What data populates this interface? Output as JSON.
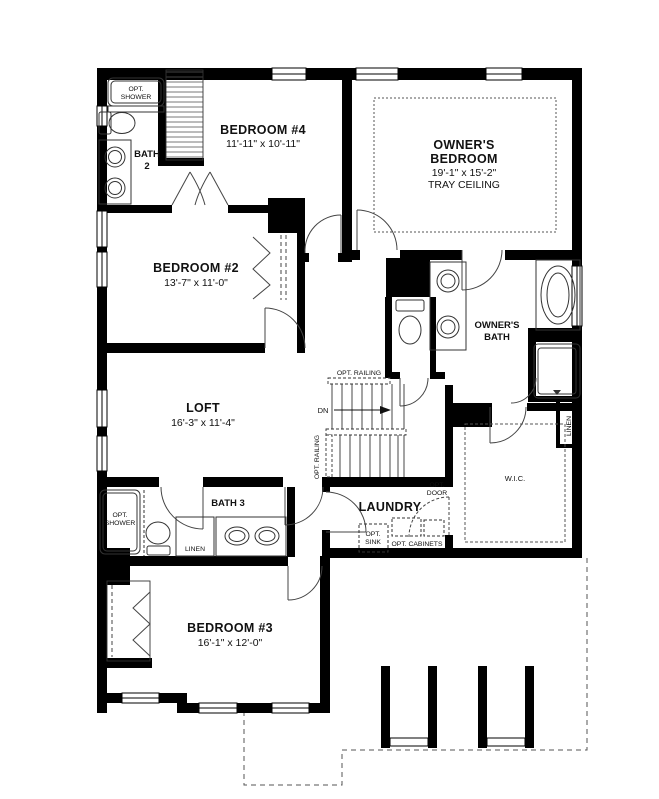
{
  "plan": {
    "rooms": {
      "bath2": {
        "line1": "BATH",
        "line2": "2"
      },
      "bedroom4": {
        "name": "BEDROOM #4",
        "dims": "11'-11\" x 10'-11\""
      },
      "owners_bedroom": {
        "line1": "OWNER'S",
        "line2": "BEDROOM",
        "dims": "19'-1\" x 15'-2\"",
        "note": "TRAY CEILING"
      },
      "bedroom2": {
        "name": "BEDROOM #2",
        "dims": "13'-7\" x 11'-0\""
      },
      "owners_bath": {
        "line1": "OWNER'S",
        "line2": "BATH"
      },
      "loft": {
        "name": "LOFT",
        "dims": "16'-3\" x 11'-4\""
      },
      "laundry": {
        "name": "LAUNDRY"
      },
      "bath3": {
        "name": "BATH 3"
      },
      "bedroom3": {
        "name": "BEDROOM #3",
        "dims": "16'-1\" x 12'-0\""
      },
      "wic": {
        "name": "W.I.C."
      }
    },
    "annotations": {
      "opt_shower_top": {
        "line1": "OPT.",
        "line2": "SHOWER"
      },
      "opt_shower_bottom": {
        "line1": "OPT.",
        "line2": "SHOWER"
      },
      "linen_owners": "LINEN",
      "linen_bath3": "LINEN",
      "opt_railing_top": "OPT. RAILING",
      "opt_railing_left": "OPT. RAILING",
      "down": "DN",
      "opt_door": {
        "line1": "OPT.",
        "line2": "DOOR"
      },
      "opt_sink": {
        "line1": "OPT.",
        "line2": "SINK"
      },
      "opt_cabinets": "OPT. CABINETS"
    },
    "colors": {
      "wall": "#000000",
      "line": "#2a2a2a",
      "background": "#ffffff"
    }
  }
}
